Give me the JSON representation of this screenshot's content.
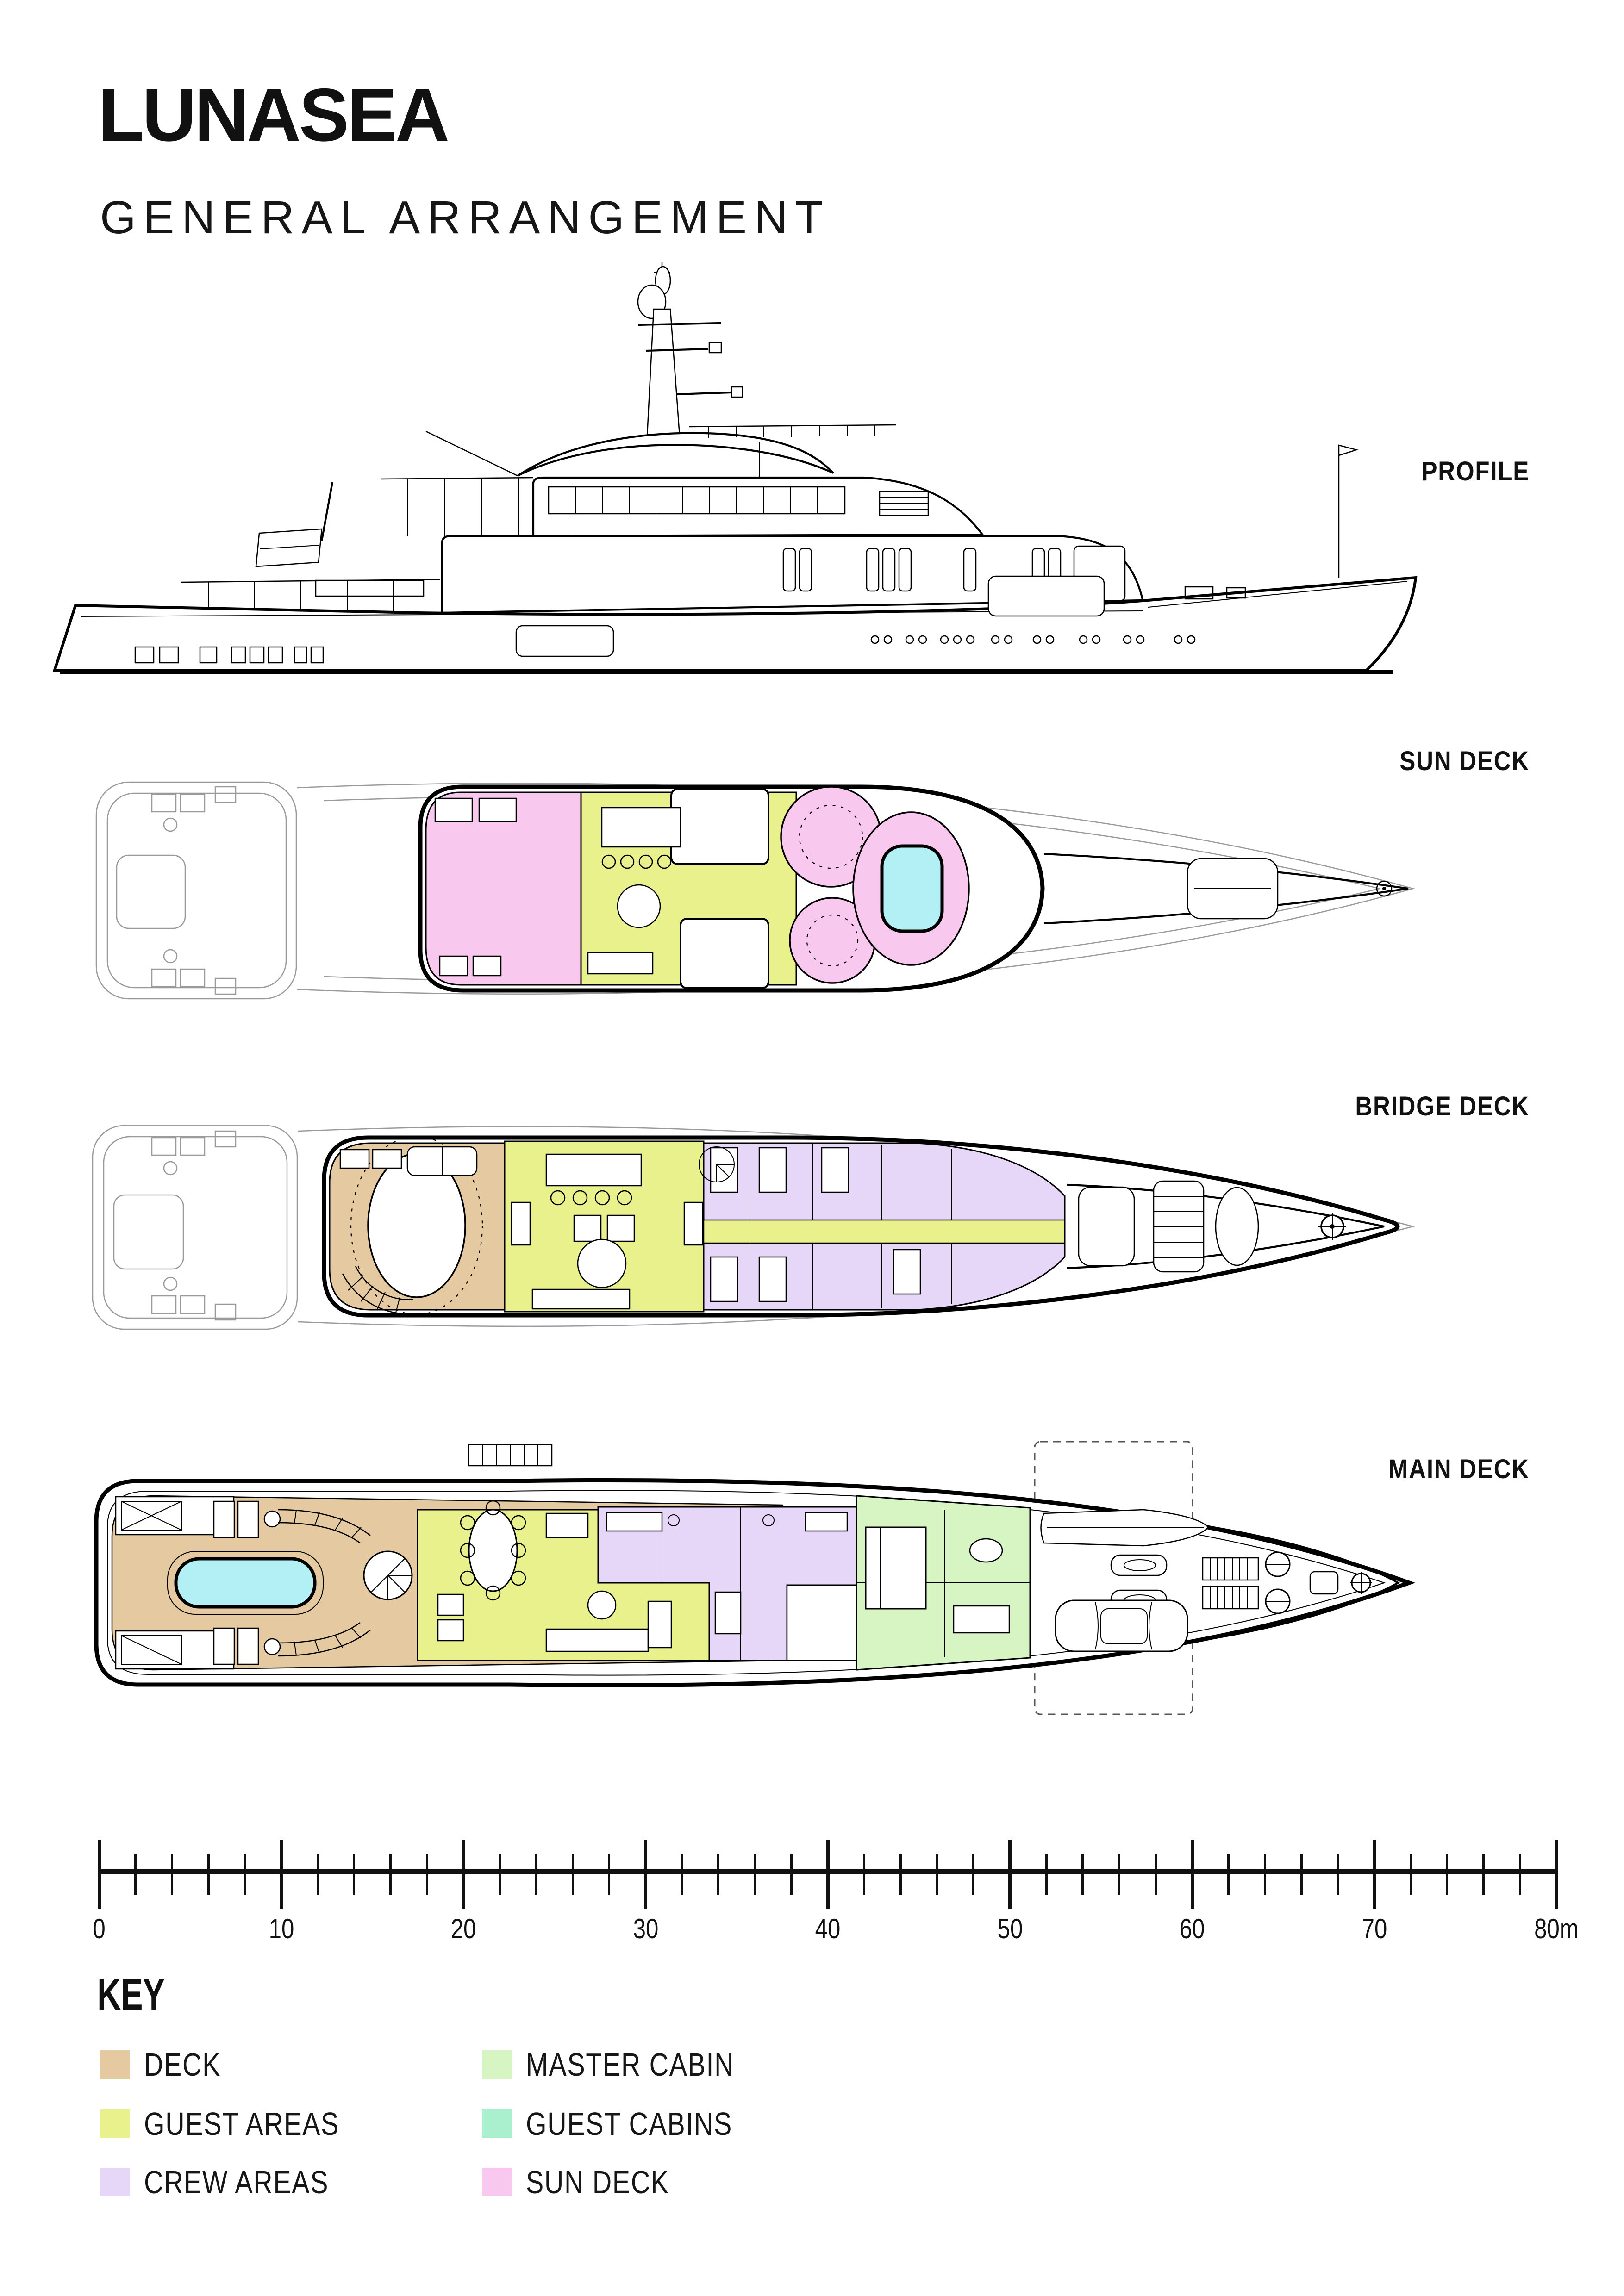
{
  "title": "LUNASEA",
  "subtitle": "GENERAL ARRANGEMENT",
  "views": {
    "profile": {
      "label": "PROFILE"
    },
    "sun_deck": {
      "label": "SUN DECK"
    },
    "bridge_deck": {
      "label": "BRIDGE DECK"
    },
    "main_deck": {
      "label": "MAIN DECK"
    }
  },
  "scale_bar": {
    "unit": "m",
    "min": 0,
    "max": 80,
    "major_tick_interval": 10,
    "minor_tick_interval": 2,
    "tick_labels": [
      "0",
      "10",
      "20",
      "30",
      "40",
      "50",
      "60",
      "70",
      "80m"
    ]
  },
  "key": {
    "heading": "KEY",
    "items": [
      {
        "id": "deck",
        "label": "DECK",
        "color": "#e5c9a1"
      },
      {
        "id": "guest-areas",
        "label": "GUEST AREAS",
        "color": "#e9f18d"
      },
      {
        "id": "crew-areas",
        "label": "CREW AREAS",
        "color": "#e6d6f7"
      },
      {
        "id": "master-cabin",
        "label": "MASTER CABIN",
        "color": "#d6f5c2"
      },
      {
        "id": "guest-cabins",
        "label": "GUEST CABINS",
        "color": "#aaf0cf"
      },
      {
        "id": "sun-deck",
        "label": "SUN DECK",
        "color": "#f9c8ef"
      }
    ]
  },
  "colors": {
    "pool": "#b3f0f5",
    "outline": "#000000",
    "ghost_outline": "#9a9a9a"
  }
}
